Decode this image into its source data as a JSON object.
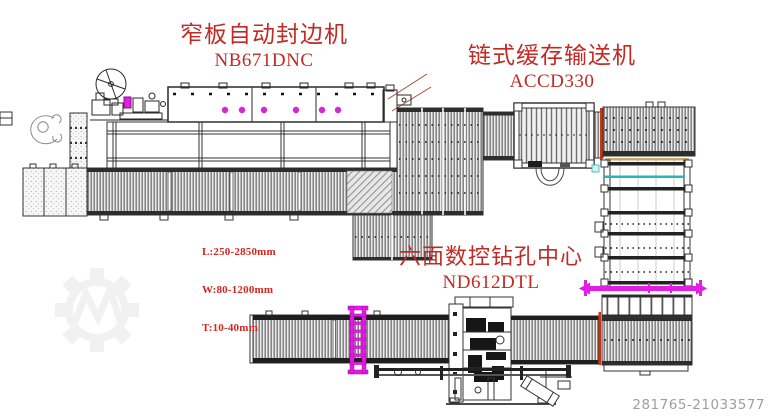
{
  "diagram_title": "Edge banding production line layout",
  "labels": {
    "edge_bander": {
      "name": "窄板自动封边机",
      "model": "NB671DNC"
    },
    "chain_buffer": {
      "name": "链式缓存输送机",
      "model": "ACCD330"
    },
    "drill_center": {
      "name": "六面数控钻孔中心",
      "model": "ND612DTL"
    }
  },
  "specs": {
    "length": "L:250-2850mm",
    "width": "W:80-1200mm",
    "thickness": "T:10-40mm"
  },
  "footer": {
    "listing_id": "281765-21033577"
  },
  "colors": {
    "label_red": "#c22a25",
    "spec_red": "#d32521",
    "magenta_accent": "#e31ee3",
    "red_accent_line": "#cc3311",
    "cyan_accent_line": "#2ab4b4",
    "tan_accent_line": "#c8a96a",
    "line_dark": "#222222",
    "id_gray": "#9e9e9e",
    "watermark_gray": "#f1f1f1"
  },
  "icons": {
    "watermark": "gear-with-m-watermark"
  }
}
